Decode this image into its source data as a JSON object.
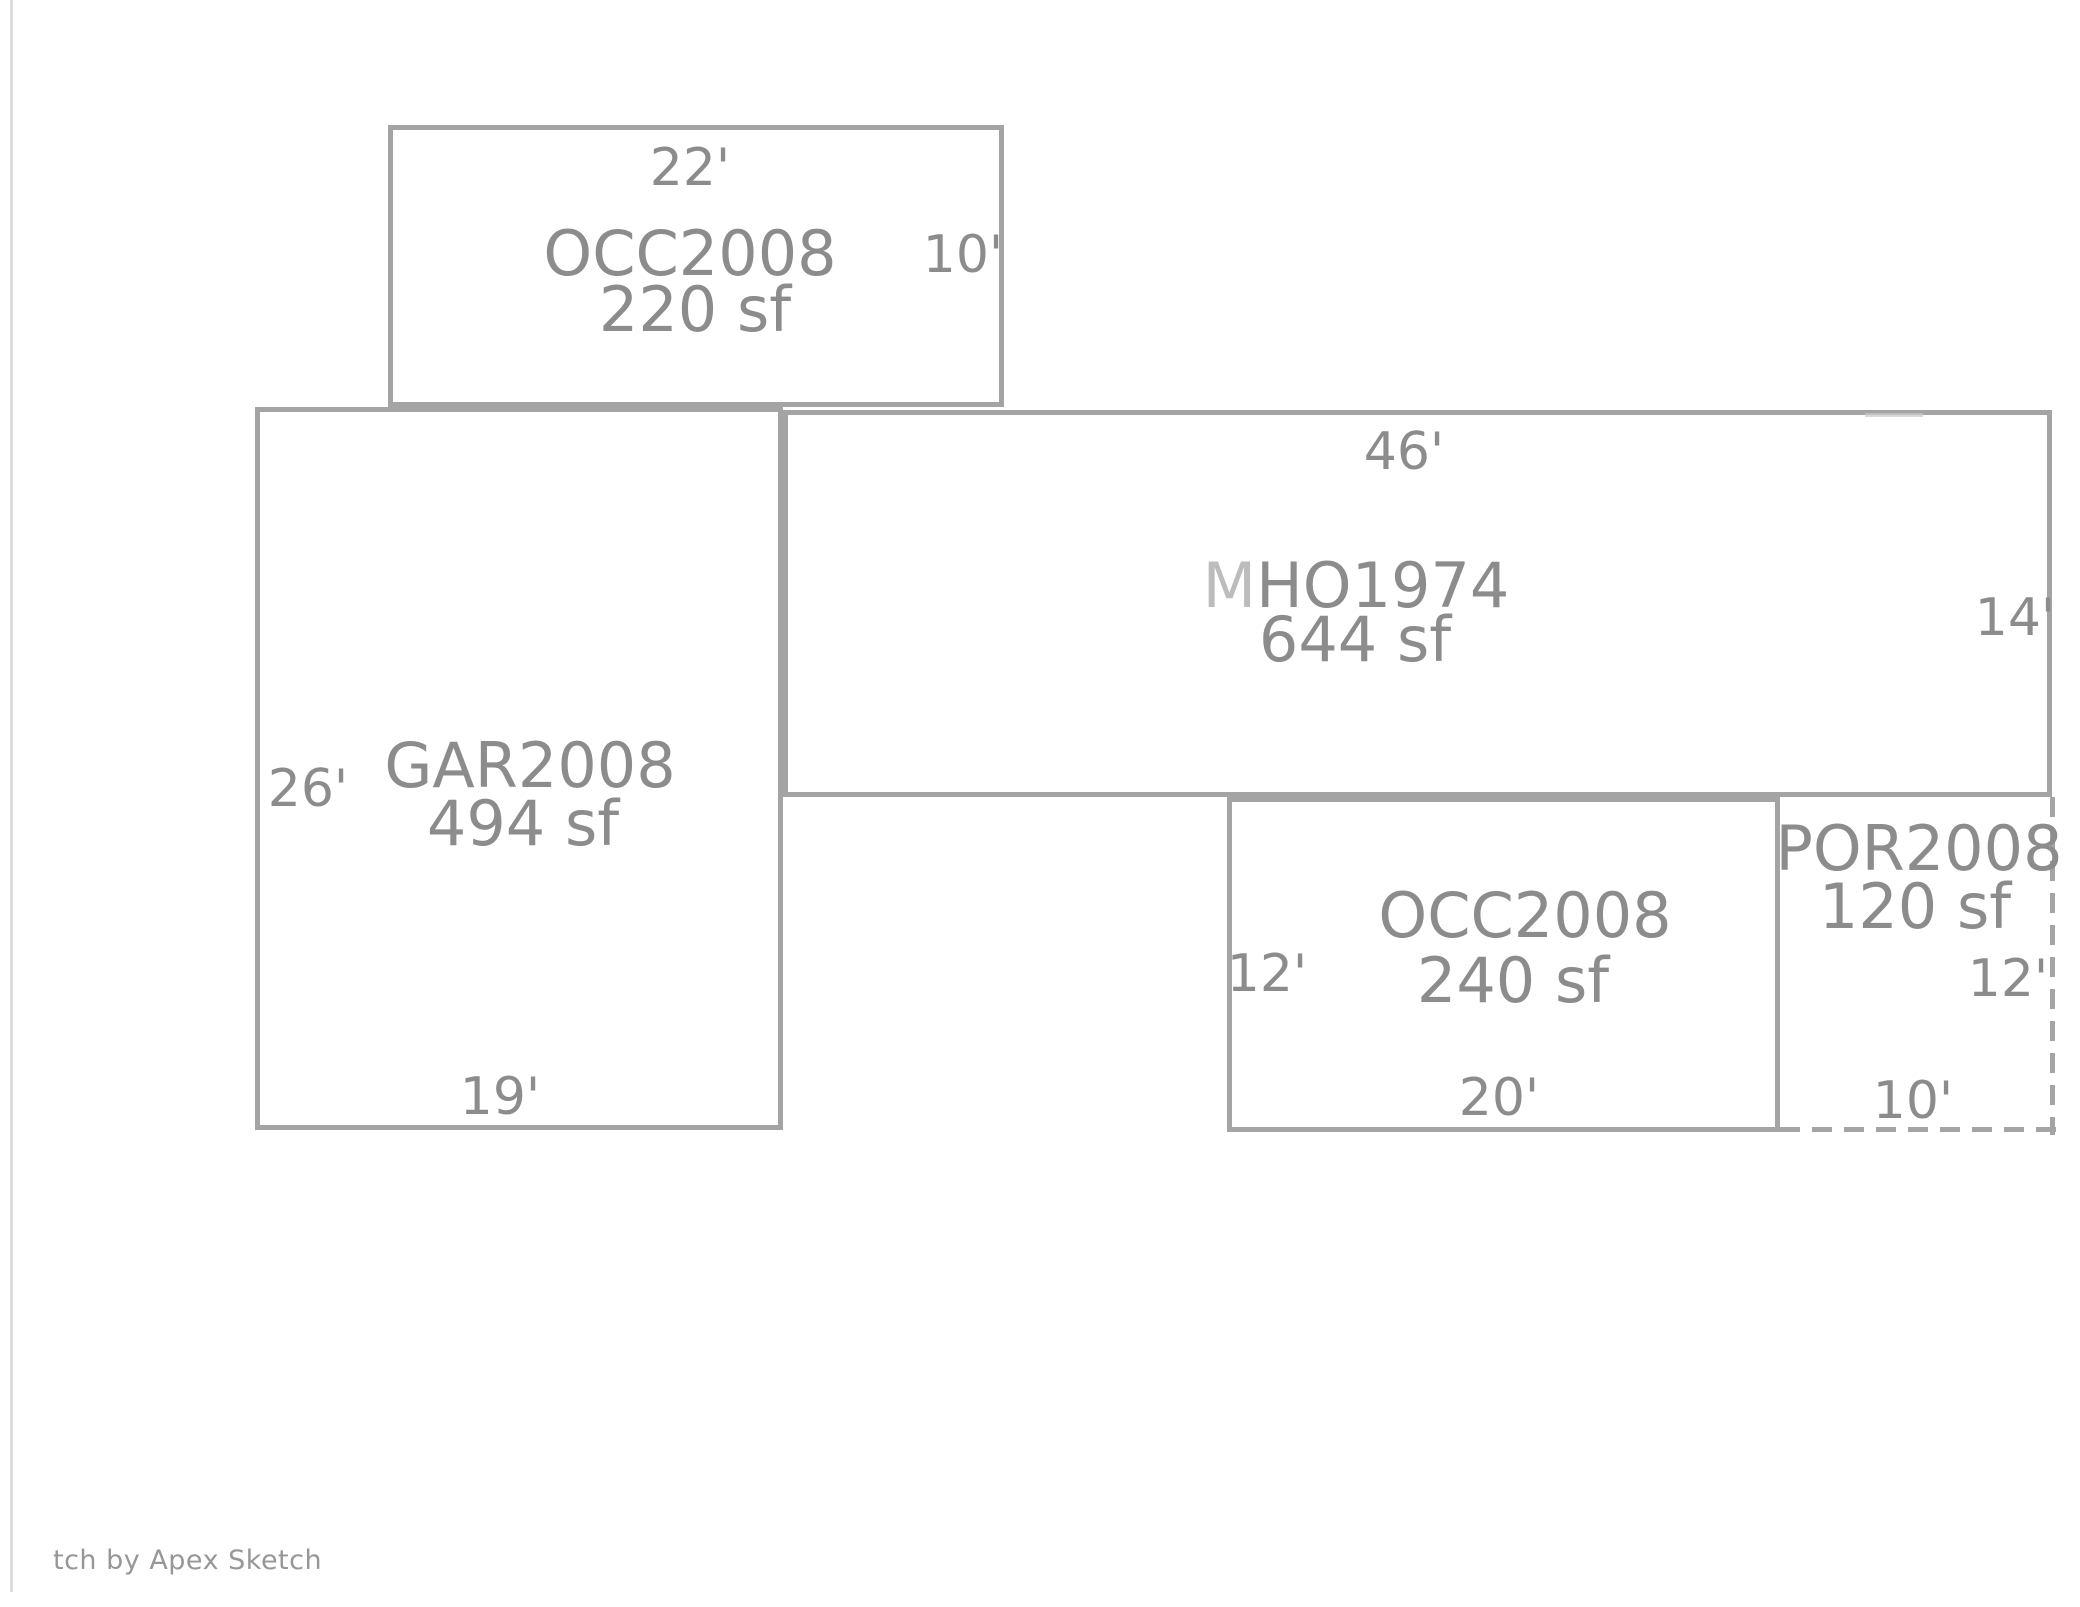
{
  "attribution": "tch by Apex Sketch",
  "areas": {
    "occ_top": {
      "code": "OCC2008",
      "area": "220 sf",
      "dim_top": "22'",
      "dim_right": "10'"
    },
    "gar": {
      "code": "GAR2008",
      "area": "494 sf",
      "dim_left": "26'",
      "dim_bottom": "19'"
    },
    "mho": {
      "code_prefix": "M",
      "code_rest": "HO1974",
      "area": "644 sf",
      "dim_top": "46'",
      "dim_right": "14'"
    },
    "occ_bottom": {
      "code": "OCC2008",
      "area": "240 sf",
      "dim_left": "12'",
      "dim_bottom": "20'"
    },
    "por": {
      "code": "POR2008",
      "area": "120 sf",
      "dim_right": "12'",
      "dim_bottom": "10'"
    }
  },
  "colors": {
    "line": "#a4a4a4",
    "label_text": "#8c8c8c",
    "label_text_light": "#bcbcbc",
    "attribution_text": "#979797"
  }
}
